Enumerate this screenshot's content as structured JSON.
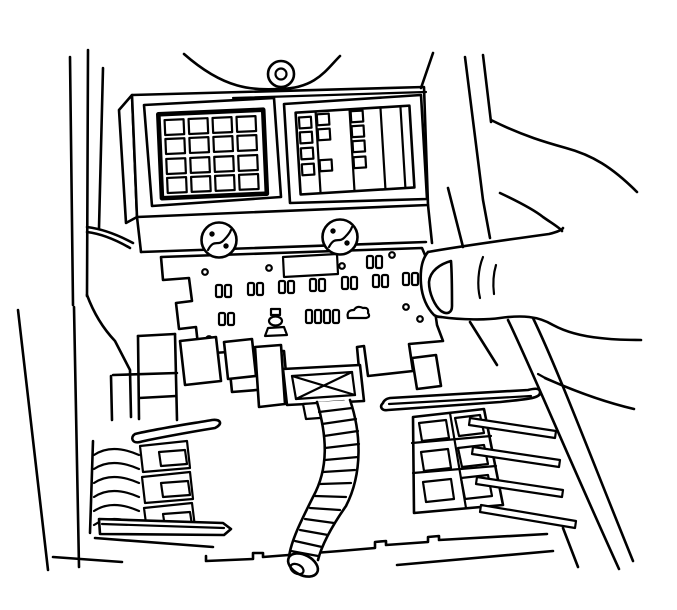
{
  "figure": {
    "description": "Black-and-white service manual line illustration: a technician's hand (entering from the right, thumb pressing the block) removes an instrument-panel junction block / fuse block. The block's top cover shows a 4x4 fuse grid on the left and a mini-fuse panel on the right, two retaining screws on the front flange, and an underside face with rows of paired terminal cavities. A corrugated wire loom curves down from a bottom connector with an X-brace. Body-harness connector pockets sit below on the left and right, with dash pillar trim lines on both sides.",
    "background_color": "#ffffff",
    "line_color": "#000000"
  },
  "components": {
    "dash_panel": {
      "label": "instrument panel / pillar trim lines"
    },
    "grommet": {
      "label": "round grommet above fuse block"
    },
    "fuse_block_top": {
      "label": "fuse block top cover"
    },
    "fuse_grid": {
      "label": "fuse array",
      "rows": 4,
      "cols": 4
    },
    "mini_fuse_panel": {
      "label": "mini-fuse panel",
      "small_squares": 11,
      "slot_columns": 5
    },
    "screws": {
      "label": "retaining screws",
      "count": 2
    },
    "junction_block_base": {
      "label": "junction block underside",
      "terminal_pairs": 9,
      "holes": 7
    },
    "harness_connector": {
      "label": "bottom harness connector with X brace"
    },
    "wire_loom": {
      "label": "corrugated wire loom",
      "ribs": 13
    },
    "left_connector": {
      "label": "left body connector pocket",
      "slot_rows": 3,
      "comb_teeth": 6
    },
    "right_connector": {
      "label": "right body connector pocket",
      "cells": 6,
      "ribs": 4
    },
    "hand": {
      "label": "technician hand gripping block"
    },
    "cowl_band": {
      "label": "diagonal cowl / pillar band"
    }
  }
}
